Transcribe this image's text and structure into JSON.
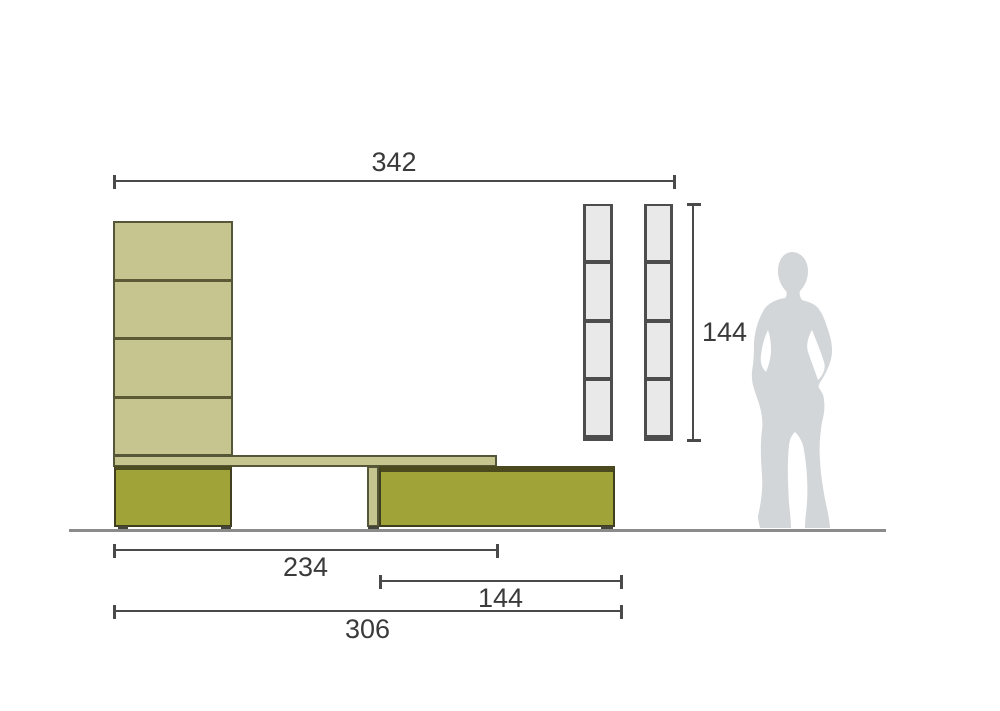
{
  "diagram": {
    "name": "wall-unit-dimension-diagram",
    "dims": {
      "top_width": "342",
      "tower_height": "144",
      "shelf_span": "234",
      "cabinet_span": "144",
      "base_span": "306"
    },
    "structure": {
      "wall_column_panels": 4,
      "wall_towers": 2,
      "tower_compartments": 4
    },
    "colors": {
      "khaki_panel": "#c6c48f",
      "olive_cabinet": "#9fa338",
      "cabinet_outline": "#3f3f1f",
      "panel_outline": "#565639",
      "tower_fill": "#e9e9e9",
      "tower_frame": "#4d4d4d",
      "dimension_line": "#4a4a4a",
      "dimension_text": "#3a3a3a",
      "floor_line": "#8b8b8b",
      "silhouette": "#d3d6d8"
    }
  }
}
